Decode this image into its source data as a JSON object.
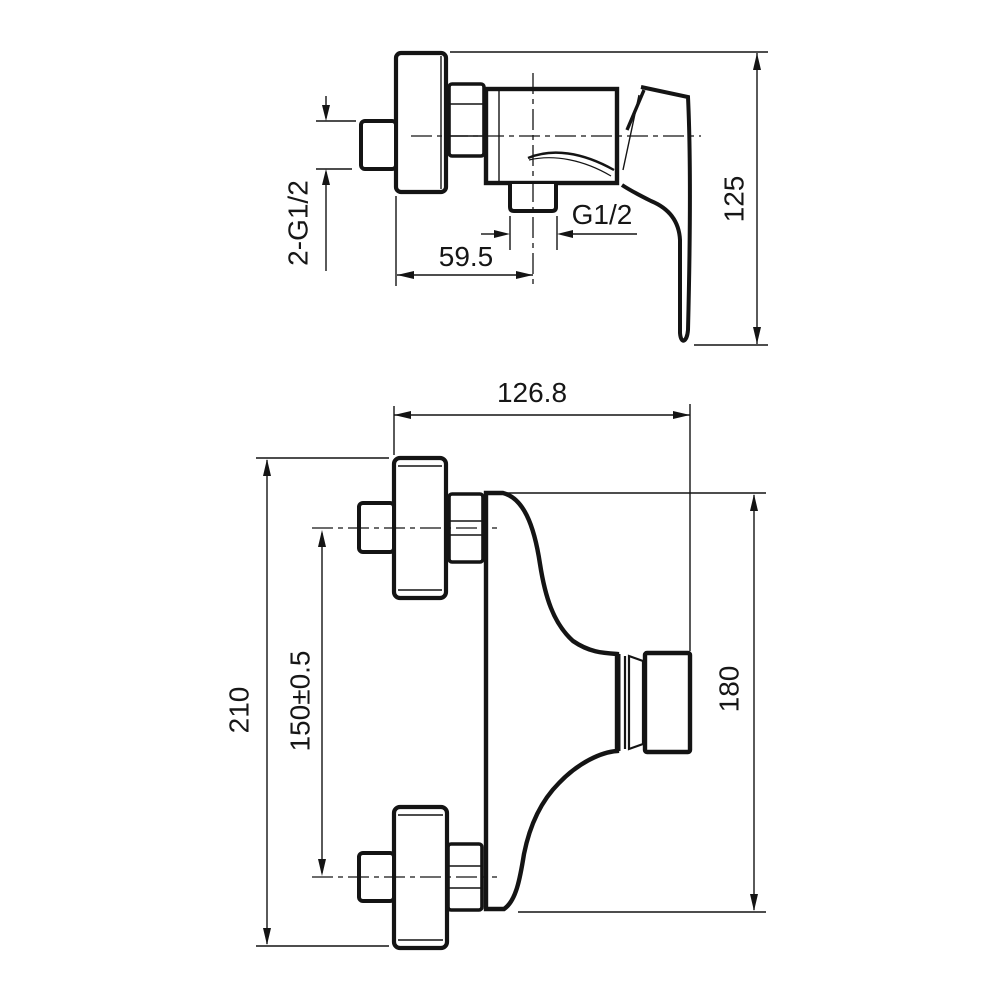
{
  "drawing": {
    "background": "#ffffff",
    "line_color": "#141414",
    "type": "technical-dimension-drawing",
    "subject": "wall-mounted shower mixer faucet, two orthographic views",
    "views": {
      "side": {
        "name": "side view (top drawing)",
        "dims": {
          "inlet_thread": "2-G1/2",
          "outlet_offset": "59.5",
          "outlet_thread": "G1/2",
          "height": "125"
        }
      },
      "front": {
        "name": "front view (bottom drawing)",
        "dims": {
          "width": "126.8",
          "inlet_spacing": "150±0.5",
          "overall_height": "210",
          "body_height": "180"
        }
      }
    }
  }
}
